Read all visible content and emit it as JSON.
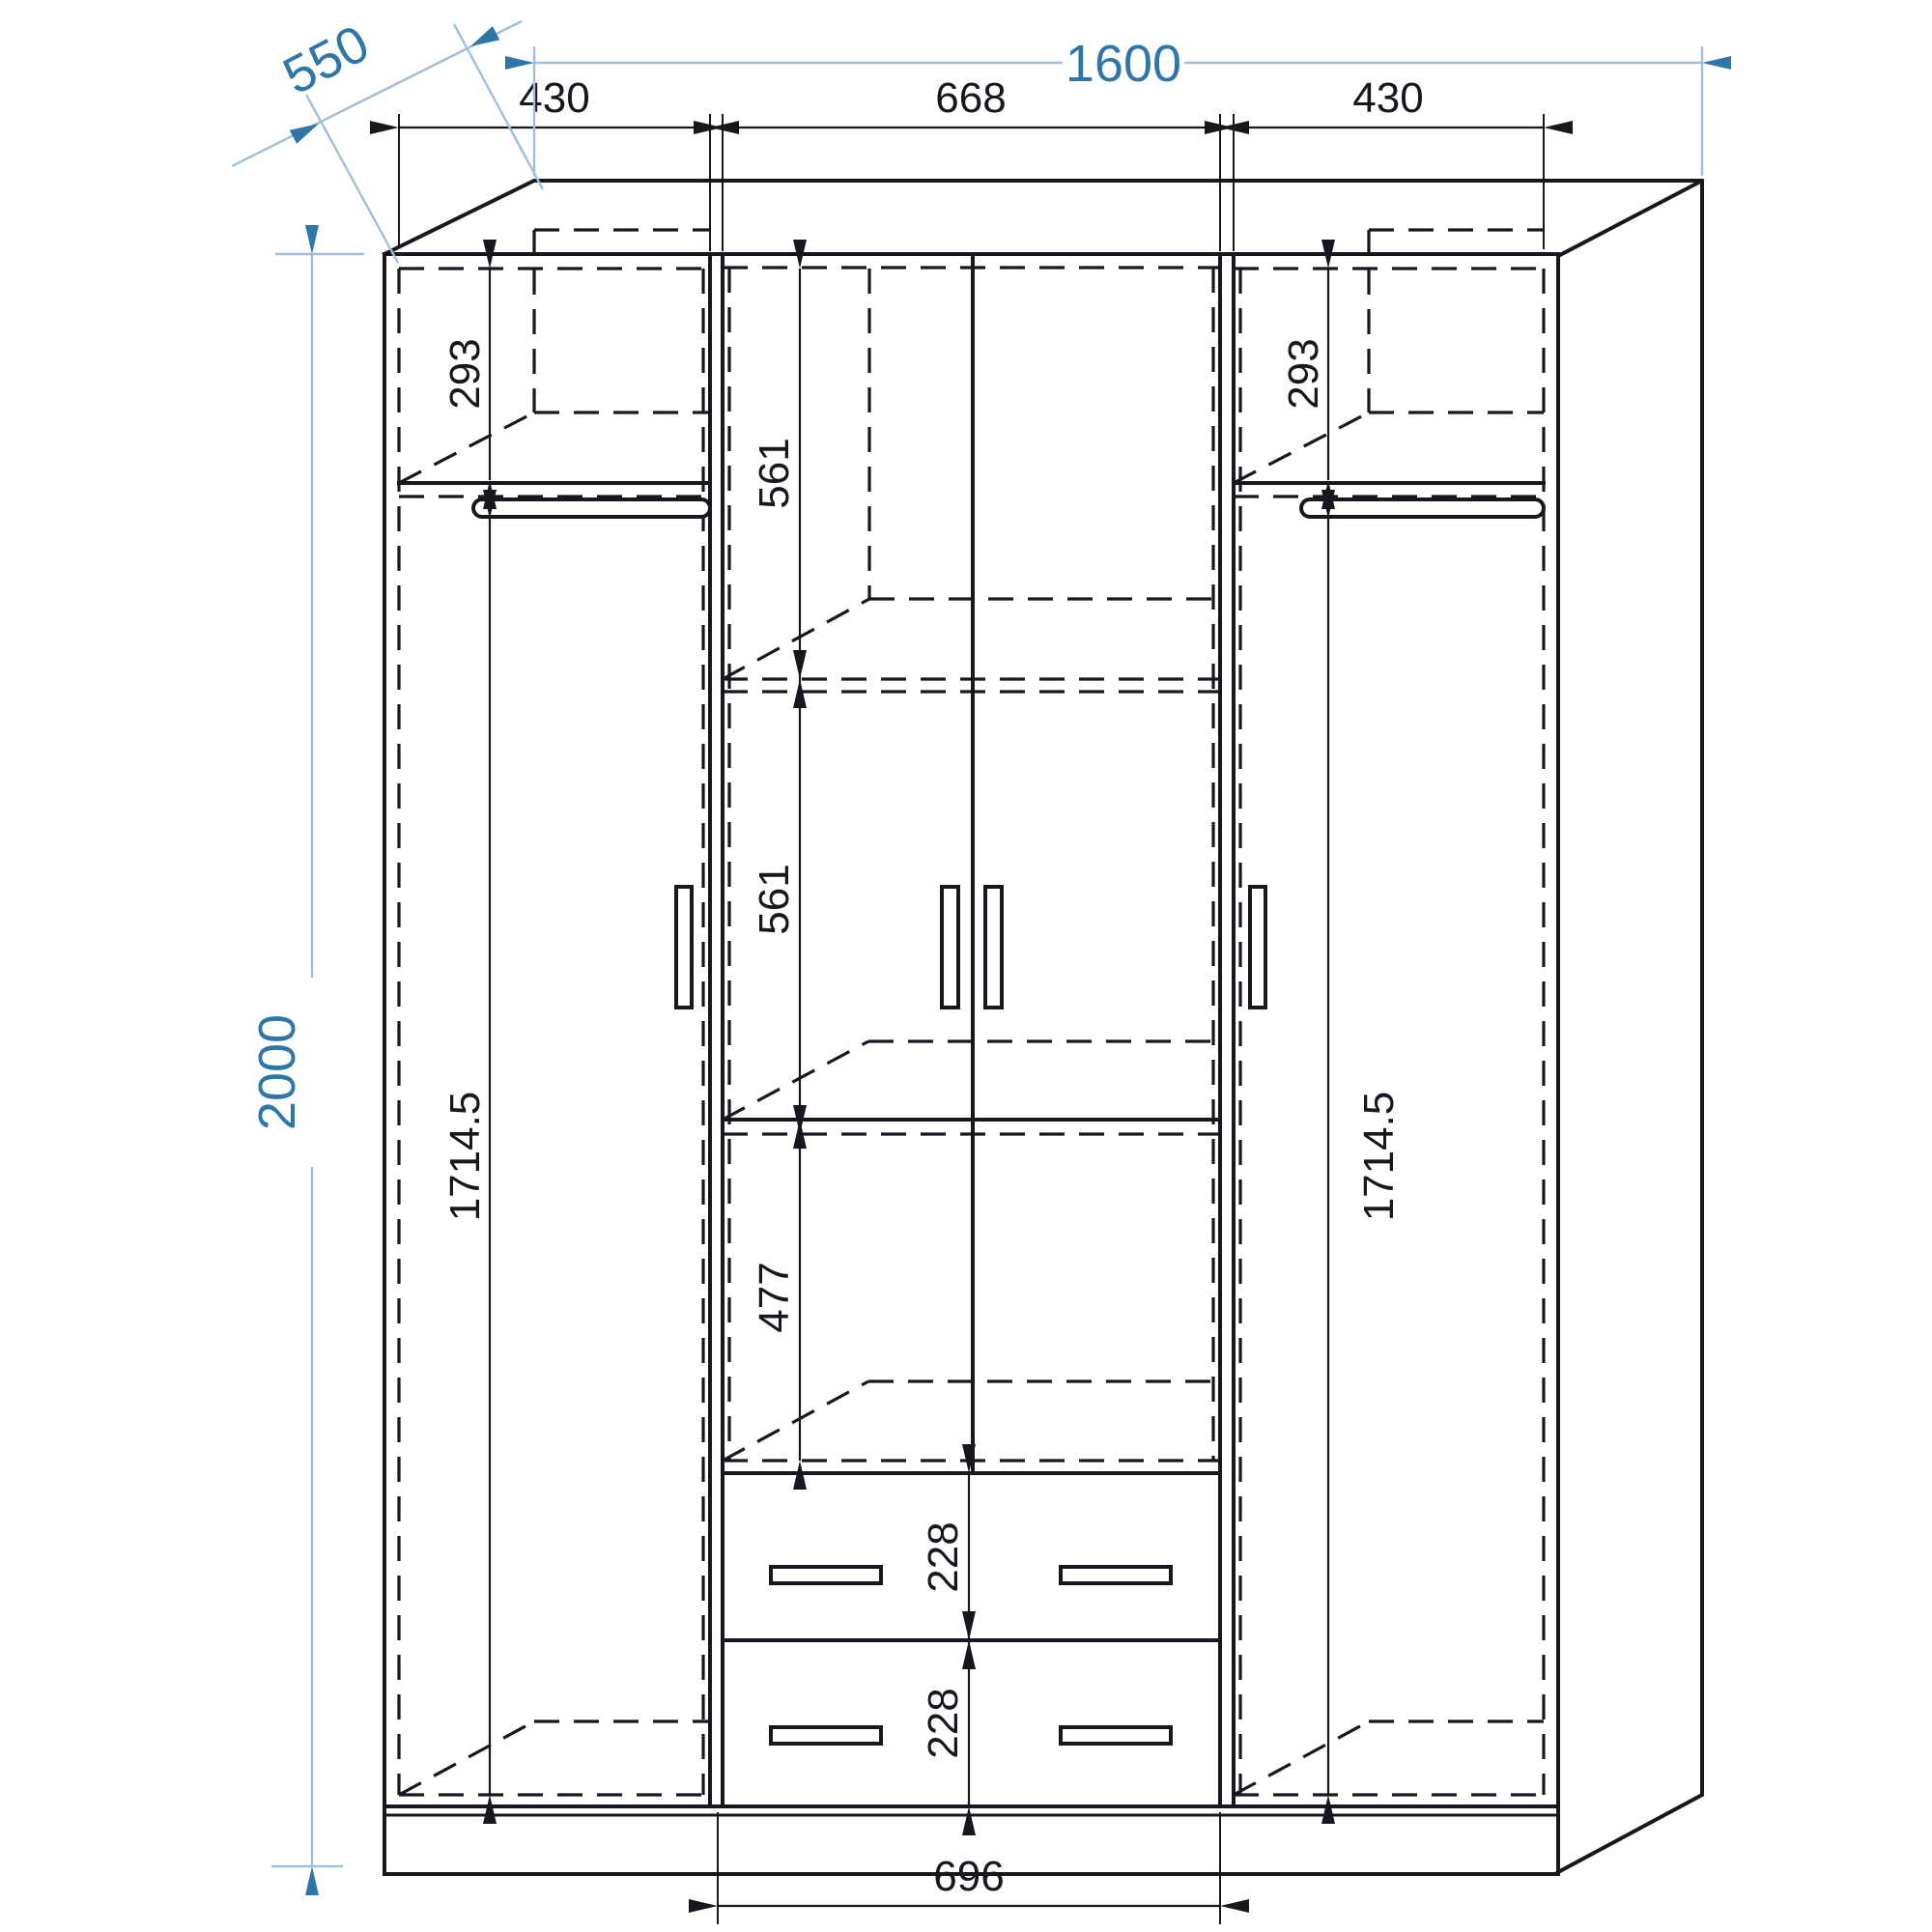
{
  "colors": {
    "line": "#17171e",
    "accent_blue": "#2e75a8",
    "light_blue": "#9fbfdb",
    "background": "#ffffff"
  },
  "dimensions": {
    "overall_width": "1600",
    "overall_depth": "550",
    "overall_height": "2000",
    "left_section_width": "430",
    "center_section_width": "668",
    "right_section_width": "430",
    "left_top_compartment_height": "293",
    "right_top_compartment_height": "293",
    "center_upper_compartment_height": "561",
    "center_middle_compartment_height": "561",
    "center_lower_compartment_height": "477",
    "left_hanging_height": "1714.5",
    "right_hanging_height": "1714.5",
    "upper_drawer_height": "228",
    "lower_drawer_height": "228",
    "drawer_section_width": "696"
  }
}
